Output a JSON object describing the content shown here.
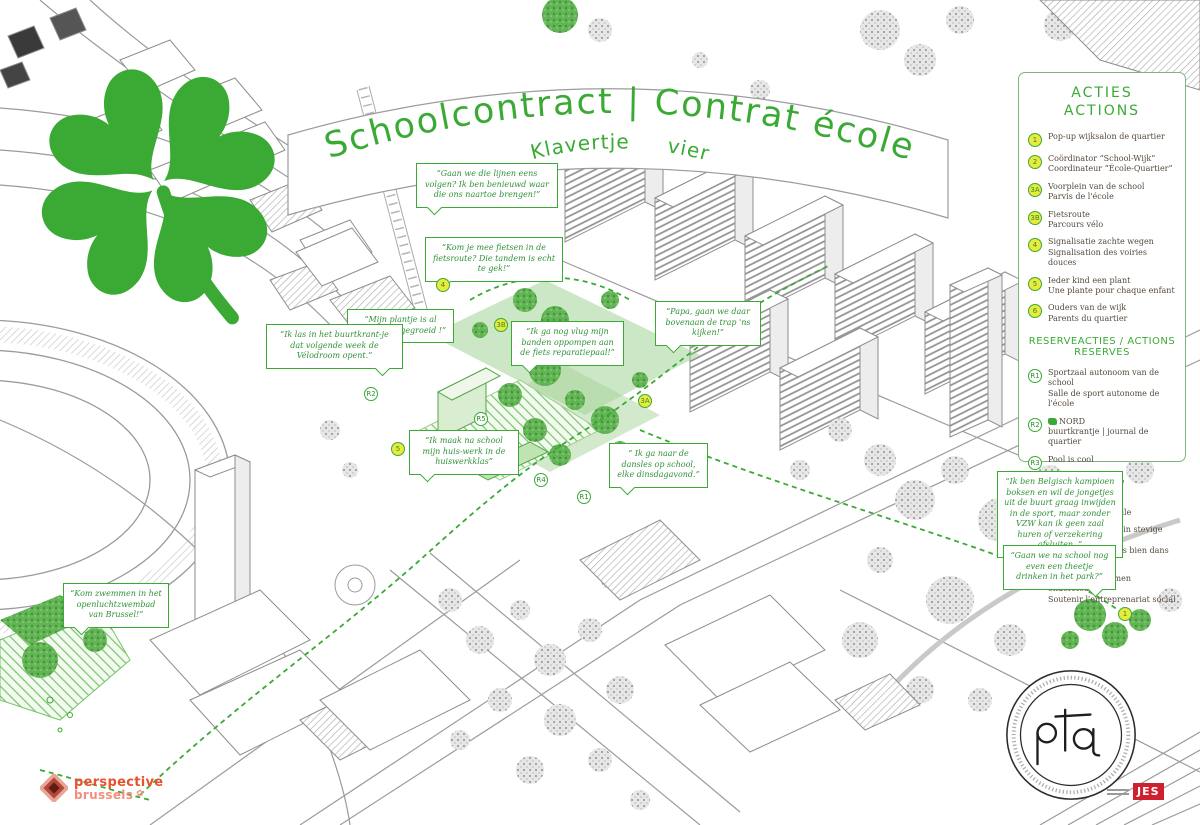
{
  "poster": {
    "title": "Schoolcontract | Contrat école",
    "subtitle": "Klavertje vier"
  },
  "legend": {
    "title_line1": "ACTIES",
    "title_line2": "ACTIONS",
    "actions": [
      {
        "badge": "1",
        "nl": "Pop-up wijksalon de quartier",
        "fr": ""
      },
      {
        "badge": "2",
        "nl": "Coördinator “School-Wijk”",
        "fr": "Coordinateur “École-Quartier”"
      },
      {
        "badge": "3A",
        "nl": "Voorplein van de school",
        "fr": "Parvis de l'école"
      },
      {
        "badge": "3B",
        "nl": "Fietsroute",
        "fr": "Parcours vélo"
      },
      {
        "badge": "4",
        "nl": "Signalisatie zachte wegen",
        "fr": "Signalisation des voiries douces"
      },
      {
        "badge": "5",
        "nl": "Ieder kind een plant",
        "fr": "Une plante pour chaque enfant"
      },
      {
        "badge": "6",
        "nl": "Ouders van de wijk",
        "fr": "Parents du quartier"
      }
    ],
    "reservations_title": "RESERVEACTIES / ACTIONS RESERVES",
    "reservations": [
      {
        "badge": "R1",
        "nl": "Sportzaal autonoom van de school",
        "fr": "Salle de sport autonome de l'école"
      },
      {
        "badge": "R2",
        "nl": "NORD",
        "fr": "buurtkrantje | journal de quartier"
      },
      {
        "badge": "R3",
        "nl": "Pool is cool",
        "fr": ""
      },
      {
        "badge": "R4",
        "nl": "Intergenerationele huiswerkklas",
        "fr": "Classe de devoirs intergénérationnelle"
      },
      {
        "badge": "R5",
        "nl": "Mama's en papa's in stevige schoenen",
        "fr": "= mamans + papas bien dans leurs baskets"
      },
      {
        "badge": "R6",
        "nl": "Sociaal ondernemen ondersteund",
        "fr": "Soutenir l'entreprenariat social"
      }
    ]
  },
  "bubbles": [
    {
      "text": "“Gaan we die lijnen eens volgen? Ik ben benieuwd waar die ons naartoe brengen!”"
    },
    {
      "text": "“Kom je mee fietsen in de fietsroute? Die tandem is echt te gek!”"
    },
    {
      "text": "“Mijn plantje is al supergoed gegroeid !”"
    },
    {
      "text": "“Ik las in het buurtkrant-je dat volgende week de Vélodroom opent.”"
    },
    {
      "text": "“Ik ga nog vlug mijn banden oppompen aan de fiets reparatiepaal!”"
    },
    {
      "text": "“Papa, gaan we daar bovenaan de trap 'ns kijken!”"
    },
    {
      "text": "“Ik maak na school mijn huis-werk in de huiswerkklas”"
    },
    {
      "text": "“ Ik ga naar de dansles op school, elke dinsdagavond.”"
    },
    {
      "text": "“Ik ben Belgisch kampioen boksen en wil de jongetjes uit de buurt graag inwijden in de sport, maar zonder VZW kan ik geen zaal huren of verzekering afsluiten. ”"
    },
    {
      "text": "“Gaan we na school nog even een theetje drinken in het park?”"
    },
    {
      "text": "“Kom zwemmen in het openluchtzwembad van Brussel!”"
    }
  ],
  "map_badges": [
    {
      "label": "4"
    },
    {
      "label": "3B"
    },
    {
      "label": "3A"
    },
    {
      "label": "R2"
    },
    {
      "label": "R5"
    },
    {
      "label": "5"
    },
    {
      "label": "R4"
    },
    {
      "label": "R1"
    },
    {
      "label": "1"
    }
  ],
  "logos": {
    "perspective_line1": "perspective",
    "perspective_line2": "brussels",
    "pta": "pta",
    "jes": "JES"
  },
  "colors": {
    "green": "#3aaa35",
    "badge_yellow": "#e8ea3d",
    "perspective_red": "#e8502e",
    "perspective_pink": "#f0907e",
    "jes_red": "#cf2030"
  }
}
